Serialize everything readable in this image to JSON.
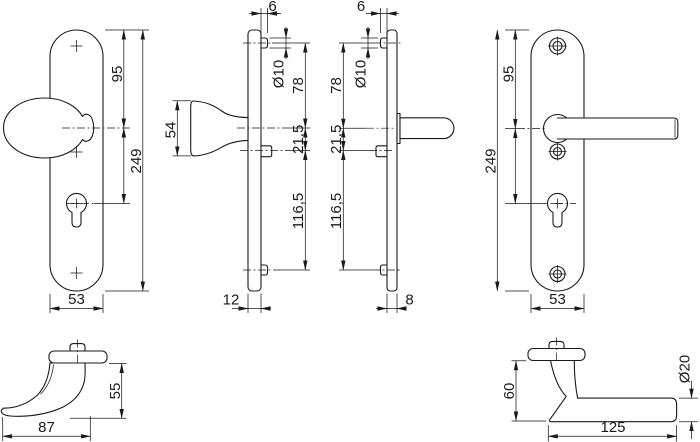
{
  "drawing": {
    "background": "#ffffff",
    "line_color": "#1a1a1a",
    "views": {
      "front_knob_plate": {
        "label": "knob backplate front view",
        "dim_top_to_knob": "95",
        "dim_total_height": "249",
        "dim_width": "53"
      },
      "side_knob_plate": {
        "label": "knob backplate side view",
        "dim_boss_depth": "6",
        "dim_screw_hole": "Ø10",
        "dim_screw_to_knob": "78",
        "dim_knob_to_clip": "21,5",
        "dim_clip_to_screw": "116,5",
        "dim_thickness": "12",
        "dim_knob_cap": "54"
      },
      "side_lever_plate": {
        "label": "lever backplate side view",
        "dim_boss_depth": "6",
        "dim_screw_hole": "Ø10",
        "dim_screw_to_lever": "78",
        "dim_lever_to_clip": "21,5",
        "dim_clip_to_screw": "116,5",
        "dim_thickness": "8"
      },
      "front_lever_plate": {
        "label": "lever backplate front view",
        "dim_top_to_lever": "95",
        "dim_total_height": "249",
        "dim_width": "53"
      },
      "profile_knob": {
        "label": "knob profile view",
        "dim_height": "55",
        "dim_projection": "87"
      },
      "profile_lever": {
        "label": "lever handle profile view",
        "dim_height": "60",
        "dim_grip_diameter": "Ø20",
        "dim_length": "125"
      }
    }
  }
}
